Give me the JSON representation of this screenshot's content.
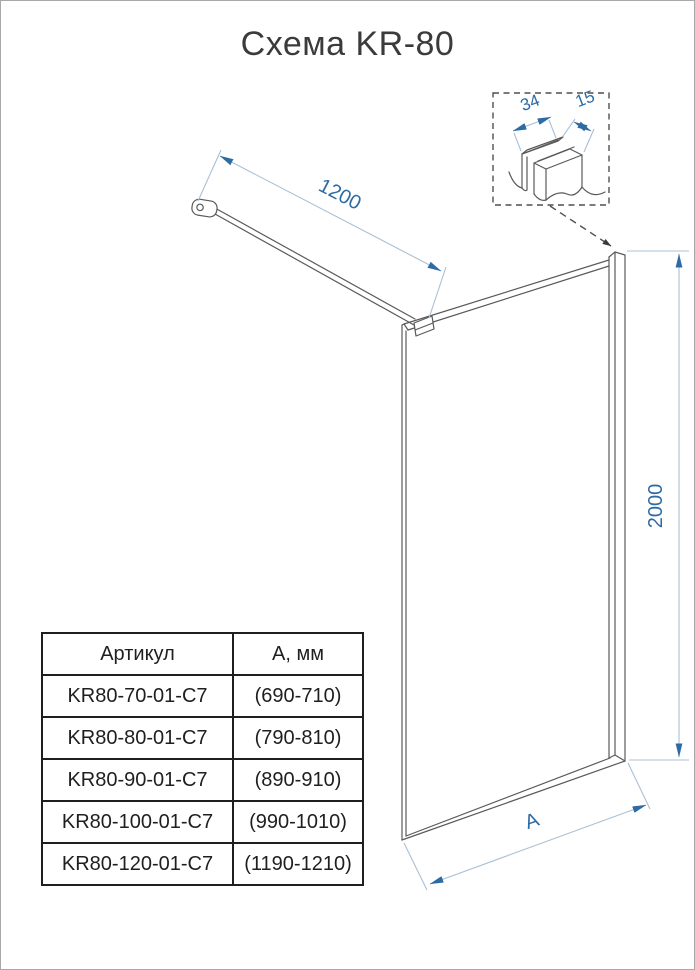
{
  "title": "Схема KR-80",
  "diagram": {
    "dim_width": "1200",
    "dim_height": "2000",
    "dim_bottom": "A",
    "detail": {
      "dim_34": "34",
      "dim_15": "15"
    }
  },
  "table": {
    "headers": [
      "Артикул",
      "А, мм"
    ],
    "rows": [
      [
        "KR80-70-01-C7",
        "(690-710)"
      ],
      [
        "KR80-80-01-C7",
        "(790-810)"
      ],
      [
        "KR80-90-01-C7",
        "(890-910)"
      ],
      [
        "KR80-100-01-C7",
        "(990-1010)"
      ],
      [
        "KR80-120-01-C7",
        "(1190-1210)"
      ]
    ]
  },
  "colors": {
    "dimension_blue": "#2e6ba4",
    "dimension_line": "#a9c0d6",
    "drawing_gray": "#5a5a5a",
    "text_dark": "#1f1f1f"
  }
}
